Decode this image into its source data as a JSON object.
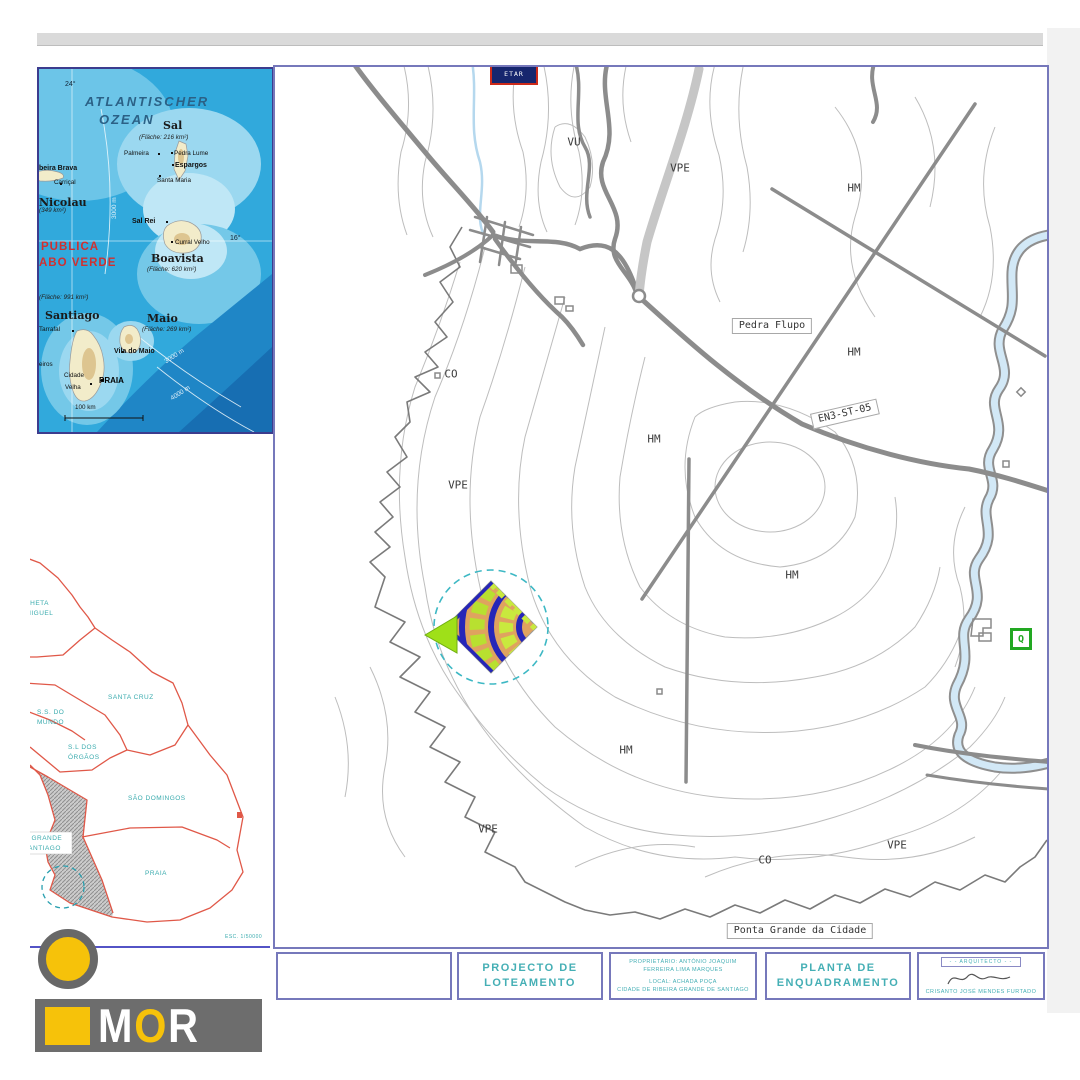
{
  "colors": {
    "frame_purple": "#7678bb",
    "inset_frame": "#3c3c8e",
    "teal_text": "#45afb5",
    "map_teal": "#3aabae",
    "red_country": "#d03030",
    "mun_red": "#e05848",
    "logo_yellow": "#f6c20a",
    "logo_gray": "#6d6d6d",
    "site_blue": "#2626b8",
    "site_orange": "#dfa35f",
    "site_green": "#c9e93e",
    "dash_circle": "#3db8c4"
  },
  "inset_cabo_verde": {
    "labels": [
      {
        "text": "24°",
        "x": 26,
        "y": 12,
        "cls": "geo"
      },
      {
        "text": "ATLANTISCHER",
        "x": 46,
        "y": 26,
        "cls": "ocean"
      },
      {
        "text": "OZEAN",
        "x": 60,
        "y": 44,
        "cls": "ocean"
      },
      {
        "text": "Sal",
        "x": 124,
        "y": 51,
        "cls": "big"
      },
      {
        "text": "(Fläche: 216 km²)",
        "x": 100,
        "y": 66,
        "cls": "area"
      },
      {
        "text": "Palmeira",
        "x": 85,
        "y": 82,
        "cls": "place"
      },
      {
        "text": "Pedra Lume",
        "x": 135,
        "y": 82,
        "cls": "place"
      },
      {
        "text": "Espargos",
        "x": 136,
        "y": 93,
        "cls": "pbold"
      },
      {
        "text": "Santa Maria",
        "x": 118,
        "y": 109,
        "cls": "place"
      },
      {
        "text": "beira Brava",
        "x": 0,
        "y": 96,
        "cls": "pbold"
      },
      {
        "text": "Carriçal",
        "x": 15,
        "y": 111,
        "cls": "place"
      },
      {
        "text": "Nicolau",
        "x": 0,
        "y": 128,
        "cls": "big"
      },
      {
        "text": "(349 km²)",
        "x": 0,
        "y": 139,
        "cls": "area"
      },
      {
        "text": "Sal Rei",
        "x": 93,
        "y": 149,
        "cls": "pbold"
      },
      {
        "text": "16°",
        "x": 191,
        "y": 166,
        "cls": "geo"
      },
      {
        "text": "Curral Velho",
        "x": 136,
        "y": 171,
        "cls": "place"
      },
      {
        "text": "Boavista",
        "x": 112,
        "y": 184,
        "cls": "big"
      },
      {
        "text": "(Fläche: 620 km²)",
        "x": 108,
        "y": 198,
        "cls": "area"
      },
      {
        "text": "PUBLICA",
        "x": 2,
        "y": 173,
        "cls": "red"
      },
      {
        "text": "ABO VERDE",
        "x": 0,
        "y": 189,
        "cls": "red"
      },
      {
        "text": "(Fläche: 991 km²)",
        "x": 0,
        "y": 226,
        "cls": "area"
      },
      {
        "text": "Santiago",
        "x": 6,
        "y": 241,
        "cls": "big"
      },
      {
        "text": "Tarrafal",
        "x": 0,
        "y": 258,
        "cls": "place"
      },
      {
        "text": "Maio",
        "x": 108,
        "y": 244,
        "cls": "big"
      },
      {
        "text": "(Fläche: 269 km²)",
        "x": 103,
        "y": 258,
        "cls": "area"
      },
      {
        "text": "Vila do Maio",
        "x": 75,
        "y": 279,
        "cls": "pbold"
      },
      {
        "text": "eiros",
        "x": 0,
        "y": 293,
        "cls": "place"
      },
      {
        "text": "Cidade",
        "x": 25,
        "y": 304,
        "cls": "place"
      },
      {
        "text": "Velha",
        "x": 26,
        "y": 316,
        "cls": "place"
      },
      {
        "text": "PRAIA",
        "x": 60,
        "y": 308,
        "cls": "praia"
      },
      {
        "text": "3000 m",
        "x": 73,
        "y": 150,
        "cls": "white",
        "rot": -90
      },
      {
        "text": "3000 m",
        "x": 125,
        "y": 291,
        "cls": "white",
        "rot": -33
      },
      {
        "text": "4000 m",
        "x": 131,
        "y": 328,
        "cls": "white",
        "rot": -33
      },
      {
        "text": "100 km",
        "x": 36,
        "y": 336,
        "cls": "place"
      }
    ]
  },
  "inset_municipalities": {
    "labels": [
      {
        "text": "CALHETA",
        "x": -14,
        "y": 66
      },
      {
        "text": "S. MIGUEL",
        "x": -14,
        "y": 76
      },
      {
        "text": "SANTA CRUZ",
        "x": 78,
        "y": 160
      },
      {
        "text": "S.S. DO",
        "x": 7,
        "y": 175
      },
      {
        "text": "MUNDO",
        "x": 7,
        "y": 185
      },
      {
        "text": "S.L DOS",
        "x": 38,
        "y": 210
      },
      {
        "text": "ÓRGÃOS",
        "x": 38,
        "y": 220
      },
      {
        "text": "SÃO DOMINGOS",
        "x": 98,
        "y": 261
      },
      {
        "text": "PRAIA",
        "x": 115,
        "y": 336
      },
      {
        "text": "RIBEIRA GRANDE",
        "x": -30,
        "y": 301
      },
      {
        "text": "DE SANTIAGO",
        "x": -19,
        "y": 311
      },
      {
        "text": "ESC. 1/50000",
        "x": 195,
        "y": 400,
        "cls": "esc"
      }
    ]
  },
  "main_map": {
    "etar_label": "ETAR",
    "q_marker": "Q",
    "zone_labels": [
      {
        "text": "VU",
        "x": 299,
        "y": 75
      },
      {
        "text": "VPE",
        "x": 405,
        "y": 101
      },
      {
        "text": "HM",
        "x": 579,
        "y": 121
      },
      {
        "text": "HM",
        "x": 579,
        "y": 285
      },
      {
        "text": "CO",
        "x": 176,
        "y": 307
      },
      {
        "text": "VPE",
        "x": 183,
        "y": 418
      },
      {
        "text": "HM",
        "x": 379,
        "y": 372
      },
      {
        "text": "HM",
        "x": 517,
        "y": 508
      },
      {
        "text": "HM",
        "x": 351,
        "y": 683
      },
      {
        "text": "VPE",
        "x": 213,
        "y": 762
      },
      {
        "text": "CO",
        "x": 490,
        "y": 793
      },
      {
        "text": "VPE",
        "x": 622,
        "y": 778
      }
    ],
    "boxed_labels": [
      {
        "text": "Pedra Flupo",
        "x": 497,
        "y": 259,
        "cls": "boxed"
      },
      {
        "text": "EN3-ST-05",
        "x": 570,
        "y": 347,
        "cls": "boxed",
        "rot": -13
      },
      {
        "text": "Ponta Grande da Cidade",
        "x": 525,
        "y": 864,
        "cls": "boxed"
      }
    ]
  },
  "title_block": {
    "project_title_line1": "PROJECTO DE",
    "project_title_line2": "LOTEAMENTO",
    "owner_line1": "PROPRIETÁRIO: ANTÓNIO JOAQUIM",
    "owner_line2": "FERREIRA LIMA MARQUES",
    "local_line1": "LOCAL: ACHADA POÇA",
    "local_line2": "CIDADE DE RIBEIRA GRANDE DE SANTIAGO",
    "drawing_title_line1": "PLANTA DE",
    "drawing_title_line2": "ENQUADRAMENTO",
    "architect_label": "- - ARQUITECTO - -",
    "architect_name": "CRISANTO JOSÉ MENDES FURTADO"
  },
  "logo": {
    "letters": [
      {
        "ch": "M",
        "color": "#ffffff"
      },
      {
        "ch": "O",
        "color": "#f6c20a"
      },
      {
        "ch": "R",
        "color": "#ffffff"
      }
    ]
  }
}
